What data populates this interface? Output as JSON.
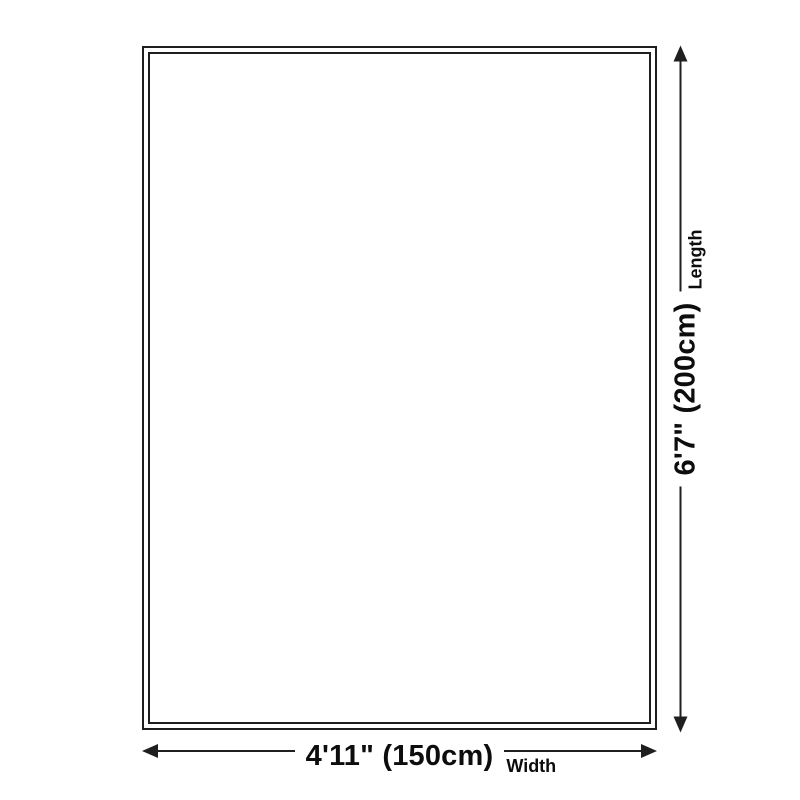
{
  "diagram": {
    "title": "rug-size-diagram",
    "width": {
      "value": "4'11\" (150cm)",
      "label": "Width"
    },
    "length": {
      "value": "6'7\" (200cm)",
      "label": "Length"
    },
    "colors": {
      "line": "#1f1f1f",
      "text": "#0d0d0d",
      "background": "#ffffff"
    }
  }
}
